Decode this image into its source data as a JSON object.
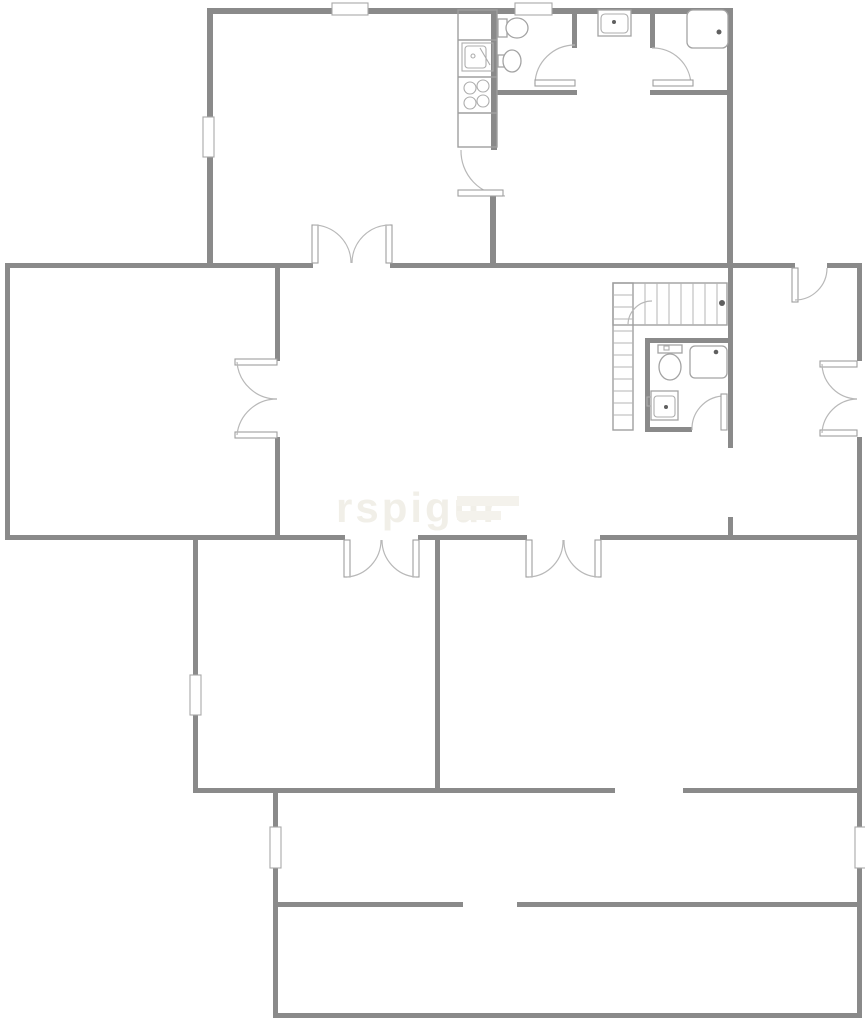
{
  "image": {
    "width": 865,
    "height": 1024,
    "background": "#ffffff"
  },
  "palette": {
    "wall": "#8a8a8a",
    "thin_line": "#9f9f9f",
    "fixture_line": "#a3a3a3",
    "door_arc": "#b8b8b8",
    "watermark": "#f1efe8"
  },
  "watermark": {
    "main": "rspigur"
  },
  "floorplan": {
    "type": "architectural-floor-plan",
    "fixtures": [
      "kitchen-counter",
      "kitchen-sink",
      "stove-4-burner",
      "toilet",
      "bidet",
      "washbasin",
      "shower-cabin",
      "staircase-l-shaped",
      "toilet-2",
      "shower-tray-2",
      "washbasin-2"
    ],
    "door_symbols": {
      "double_swing_doors": 5,
      "single_swing_doors": 5
    },
    "window_markers": 7
  }
}
